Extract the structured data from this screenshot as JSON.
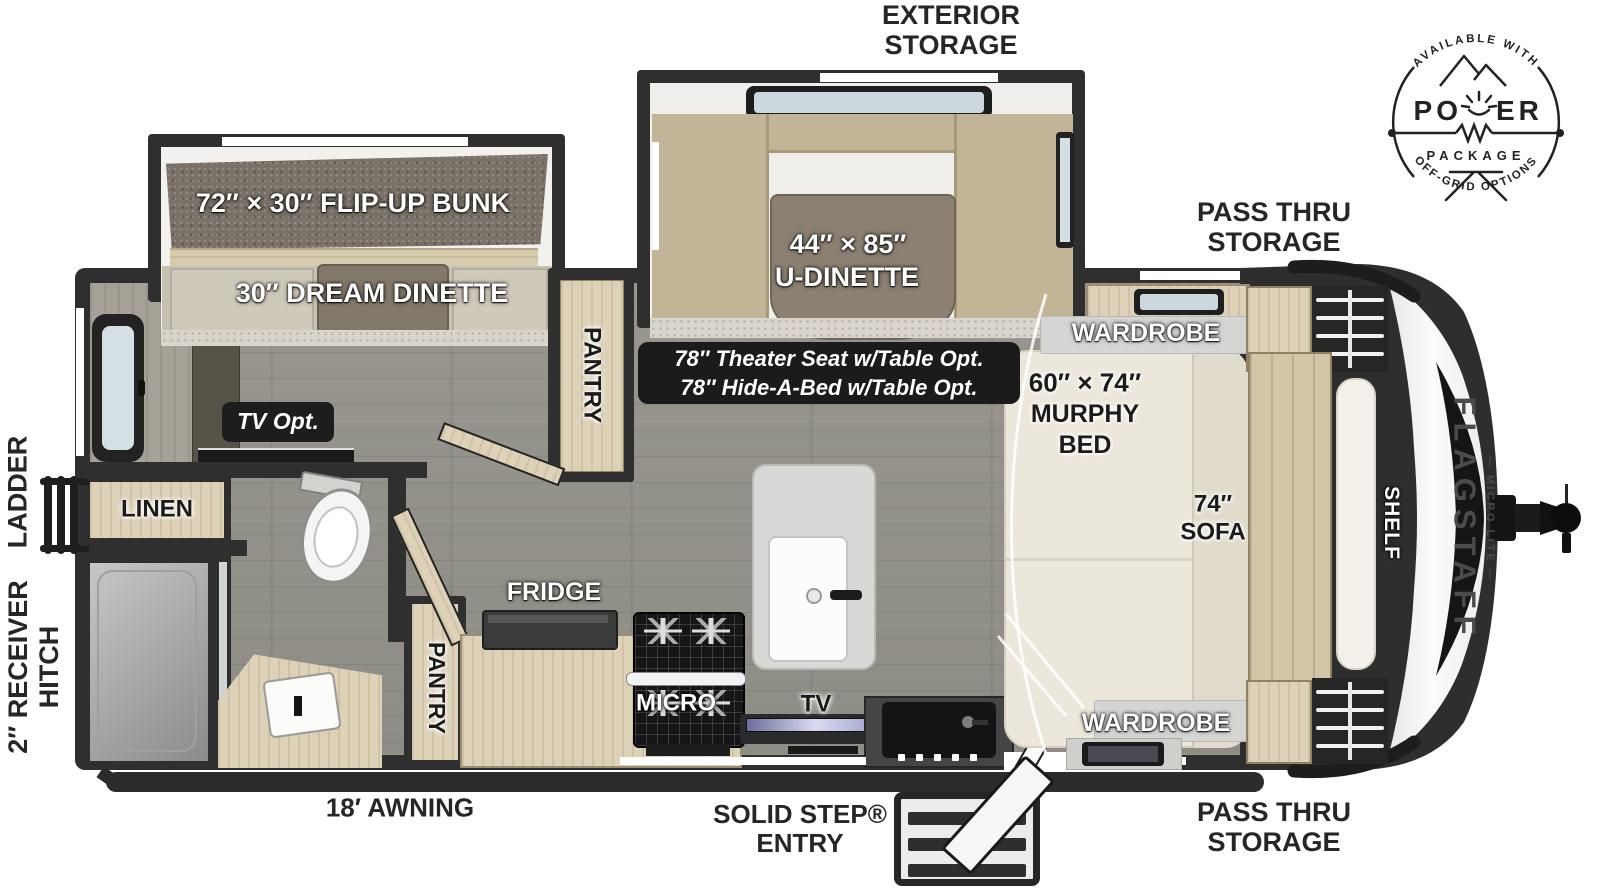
{
  "colors": {
    "wall": "#2f2f2f",
    "wood": "#dbcfb4",
    "floor": "#94938c",
    "cushion": "#c2b497",
    "bed": "#ebe7db",
    "label_dark": "#262626",
    "glass": "#ccd8de"
  },
  "badge": {
    "available_with": "AVAILABLE WITH",
    "power_left": "PO",
    "power_right": "ER",
    "package": "PACKAGE",
    "off_grid": "OFF-GRID OPTIONS"
  },
  "exterior": {
    "exterior_storage": [
      "EXTERIOR",
      "STORAGE"
    ],
    "pass_thru_top": [
      "PASS THRU",
      "STORAGE"
    ],
    "pass_thru_bottom": [
      "PASS THRU",
      "STORAGE"
    ],
    "solid_step": [
      "SOLID STEP®",
      "ENTRY"
    ],
    "awning": "18′ AWNING",
    "ladder": "LADDER",
    "receiver": [
      "2″ RECEIVER",
      "HITCH"
    ]
  },
  "interior": {
    "bunk": "72″ × 30″ FLIP-UP BUNK",
    "dream_dinette": "30″ DREAM DINETTE",
    "u_dinette": [
      "44″ × 85″",
      "U-DINETTE"
    ],
    "options": [
      "78″ Theater Seat w/Table Opt.",
      "78″ Hide-A-Bed w/Table Opt."
    ],
    "tv_opt": "TV Opt.",
    "pantry_hall": "PANTRY",
    "pantry_kitchen": "PANTRY",
    "linen": "LINEN",
    "fridge": "FRIDGE",
    "micro": "MICRO",
    "tv": "TV",
    "wardrobe_top": "WARDROBE",
    "wardrobe_bottom": "WARDROBE",
    "murphy": [
      "60″ × 74″",
      "MURPHY",
      "BED"
    ],
    "sofa": [
      "74″",
      "SOFA"
    ],
    "shelf": "SHELF"
  },
  "brand": {
    "name": "FLAGSTAFF",
    "series": "— MICRO LITE —"
  }
}
